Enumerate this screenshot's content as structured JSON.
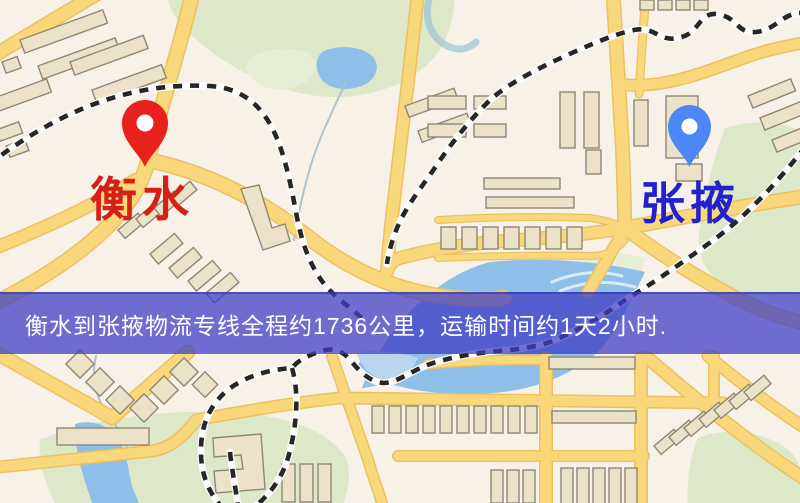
{
  "banner": {
    "text": "衡水到张掖物流专线全程约1736公里，运输时间约1天2小时.",
    "background_color": "#5a5ace",
    "text_color": "#ffffff"
  },
  "origin": {
    "label": "衡水",
    "pin_color": "#e8211c",
    "label_color": "#d81f16"
  },
  "destination": {
    "label": "张掖",
    "pin_color": "#4b87f5",
    "label_color": "#2121cd"
  },
  "map_colors": {
    "land": "#f7f1e8",
    "road": "#f9d87c",
    "park": "#dde8c8",
    "water": "#8fbfe8",
    "building": "#ebe2c7",
    "railway": "#262626"
  }
}
